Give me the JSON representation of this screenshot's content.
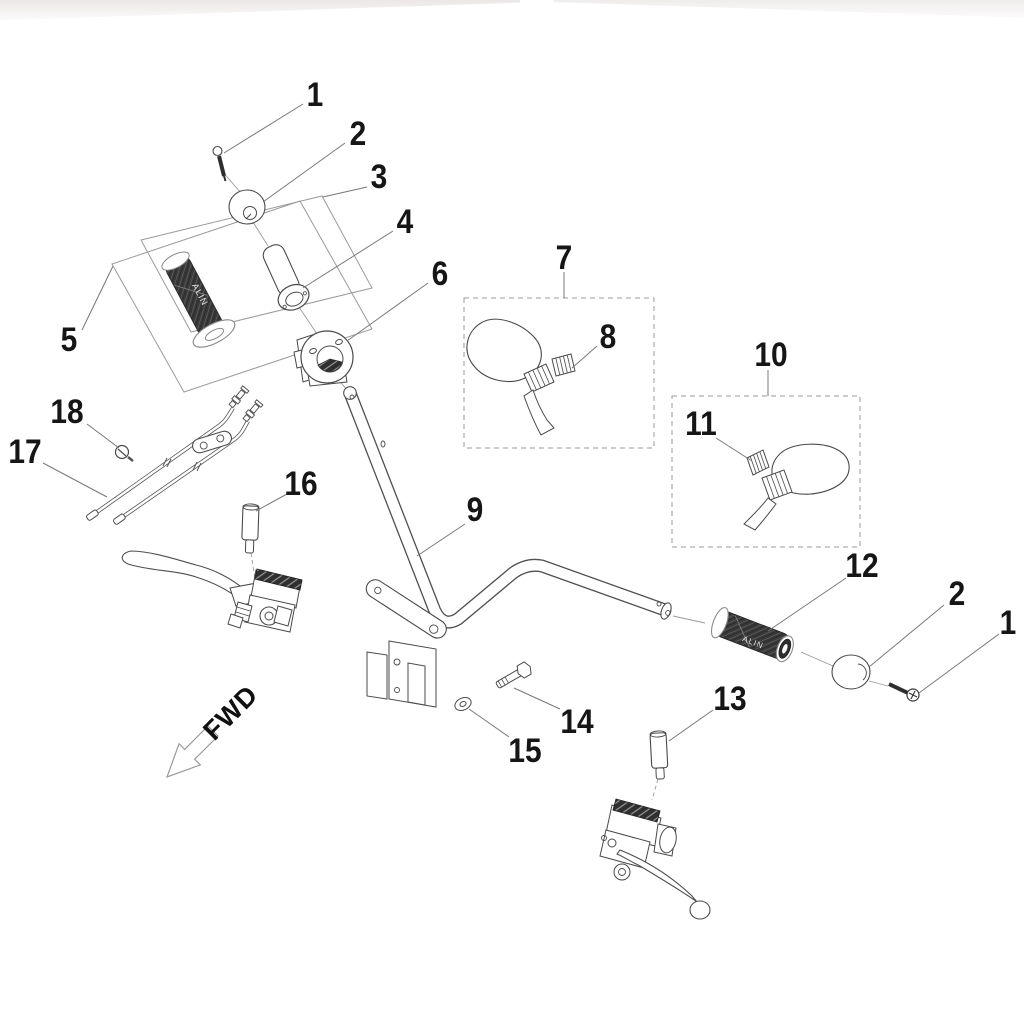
{
  "diagram": {
    "type": "exploded-parts-diagram",
    "subject": "Handlebar assembly",
    "direction_label": "FWD",
    "grip_text": "ALIN",
    "line_color": "#4a4a4a",
    "leader_color": "#787878",
    "box_color": "#9b9b9b",
    "callouts": [
      {
        "id": "callout-1-left",
        "label": "1"
      },
      {
        "id": "callout-2-left",
        "label": "2"
      },
      {
        "id": "callout-3",
        "label": "3"
      },
      {
        "id": "callout-4",
        "label": "4"
      },
      {
        "id": "callout-5",
        "label": "5"
      },
      {
        "id": "callout-6",
        "label": "6"
      },
      {
        "id": "callout-7",
        "label": "7"
      },
      {
        "id": "callout-8",
        "label": "8"
      },
      {
        "id": "callout-9",
        "label": "9"
      },
      {
        "id": "callout-10",
        "label": "10"
      },
      {
        "id": "callout-11",
        "label": "11"
      },
      {
        "id": "callout-12",
        "label": "12"
      },
      {
        "id": "callout-13",
        "label": "13"
      },
      {
        "id": "callout-14",
        "label": "14"
      },
      {
        "id": "callout-15",
        "label": "15"
      },
      {
        "id": "callout-16",
        "label": "16"
      },
      {
        "id": "callout-17",
        "label": "17"
      },
      {
        "id": "callout-18",
        "label": "18"
      },
      {
        "id": "callout-2-right",
        "label": "2"
      },
      {
        "id": "callout-1-right",
        "label": "1"
      }
    ]
  }
}
